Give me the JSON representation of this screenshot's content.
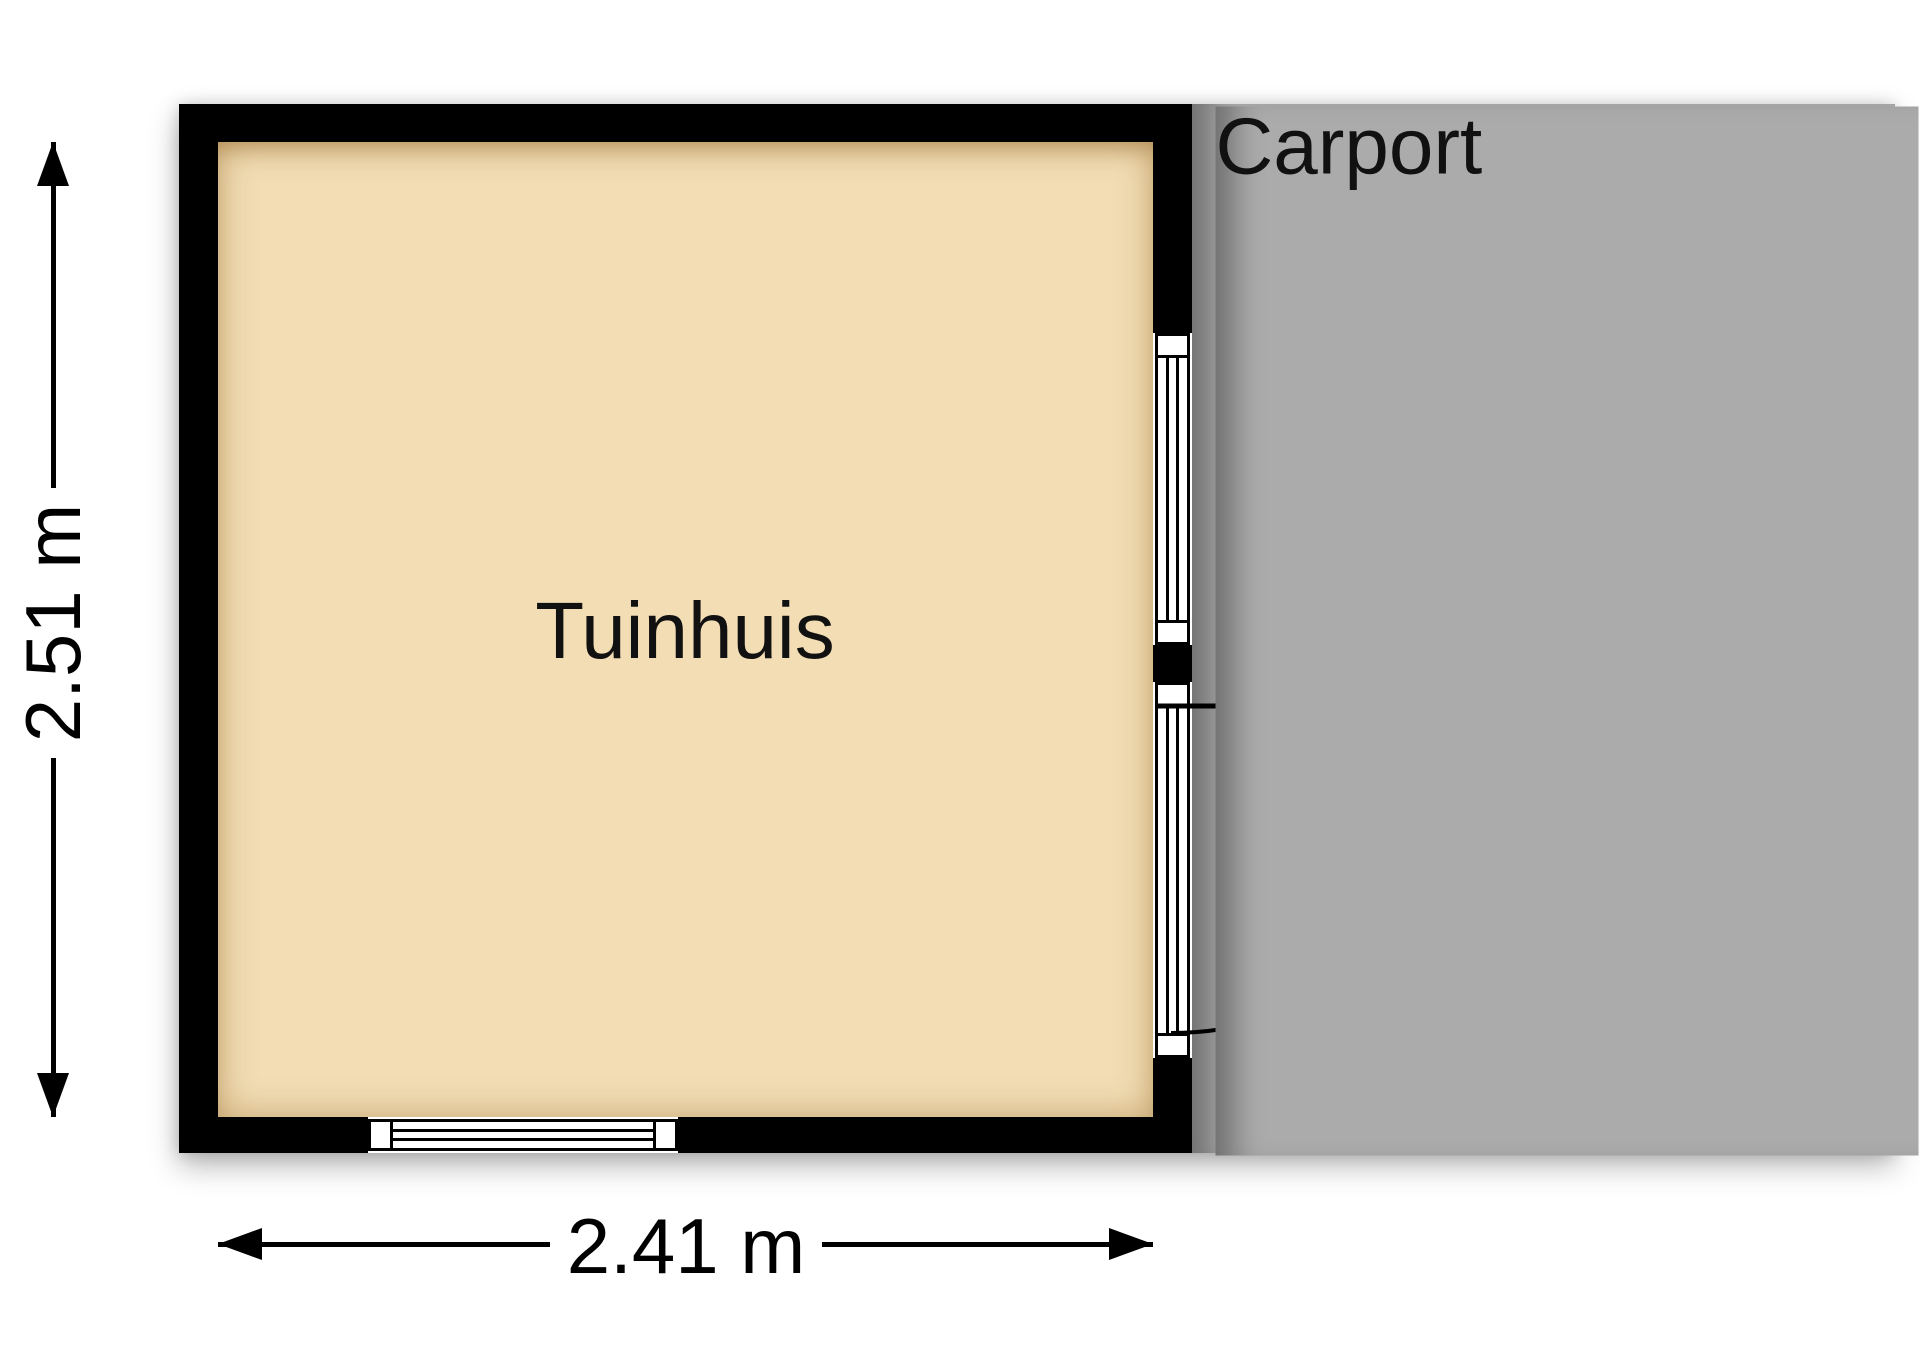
{
  "floorplan": {
    "rooms": [
      {
        "id": "tuinhuis",
        "label": "Tuinhuis"
      },
      {
        "id": "carport",
        "label": "Carport"
      }
    ],
    "dimensions": {
      "height_label": "2.51 m",
      "width_label": "2.41 m"
    },
    "features": {
      "door": "door-swing-into-carport",
      "windows": [
        "right-wall-window",
        "bottom-wall-window"
      ]
    },
    "colors": {
      "wall": "#000000",
      "tuinhuis_floor": "#F2DDB4",
      "carport_floor": "#ABABAB",
      "background": "#FFFFFF",
      "text": "#111111"
    }
  }
}
